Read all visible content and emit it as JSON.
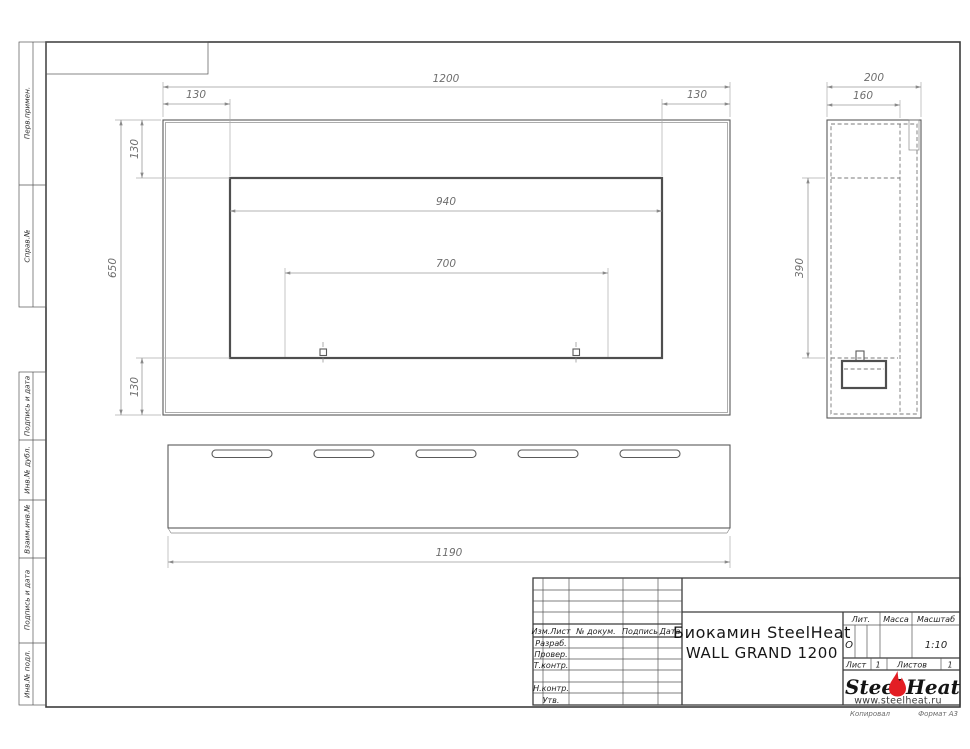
{
  "margin_labels": [
    "Перв.примен.",
    "Справ.№",
    "Подпись и дата",
    "Инв.№ дубл.",
    "Взаим.инв.№",
    "Подпись и дата",
    "Инв.№ подл."
  ],
  "front_view": {
    "dim_overall_width": "1200",
    "dim_margin_left": "130",
    "dim_margin_right": "130",
    "dim_height": "650",
    "dim_top_margin": "130",
    "dim_bottom_margin": "130",
    "dim_opening_width": "940",
    "dim_burner_span": "700"
  },
  "side_view": {
    "dim_depth": "200",
    "dim_inner_depth": "160",
    "dim_opening_height": "390"
  },
  "bottom_view": {
    "dim_width": "1190"
  },
  "title_block": {
    "rev_header": {
      "col_izm_list": "Изм.Лист",
      "col_doc": "№ докум.",
      "col_sign": "Подпись",
      "col_date": "Дата"
    },
    "row_labels": [
      "Разраб.",
      "Провер.",
      "Т.контр.",
      "Н.контр.",
      "Утв."
    ],
    "doc_title_line1": "Биокамин SteelHeat",
    "doc_title_line2": "WALL GRAND 1200",
    "lit_label": "Лит.",
    "lit_value": "О",
    "mass_label": "Масса",
    "scale_label": "Масштаб",
    "scale_value": "1:10",
    "sheet_label": "Лист",
    "sheet_number": "1",
    "sheets_label": "Листов",
    "sheets_total": "1",
    "logo": {
      "steel": "Steel",
      "heat": "Heat",
      "url": "www.steelheat.ru",
      "flame_color": "#e31e24"
    },
    "footer": {
      "copied": "Копировал",
      "format": "Формат А3"
    }
  },
  "colors": {
    "object_line": "#5a5a5a",
    "hidden_line": "#787878",
    "dimension_line": "#9a9a9a",
    "dimension_text": "#6e6e6e",
    "frame": "#3c3c3c",
    "flame": "#e31e24"
  }
}
